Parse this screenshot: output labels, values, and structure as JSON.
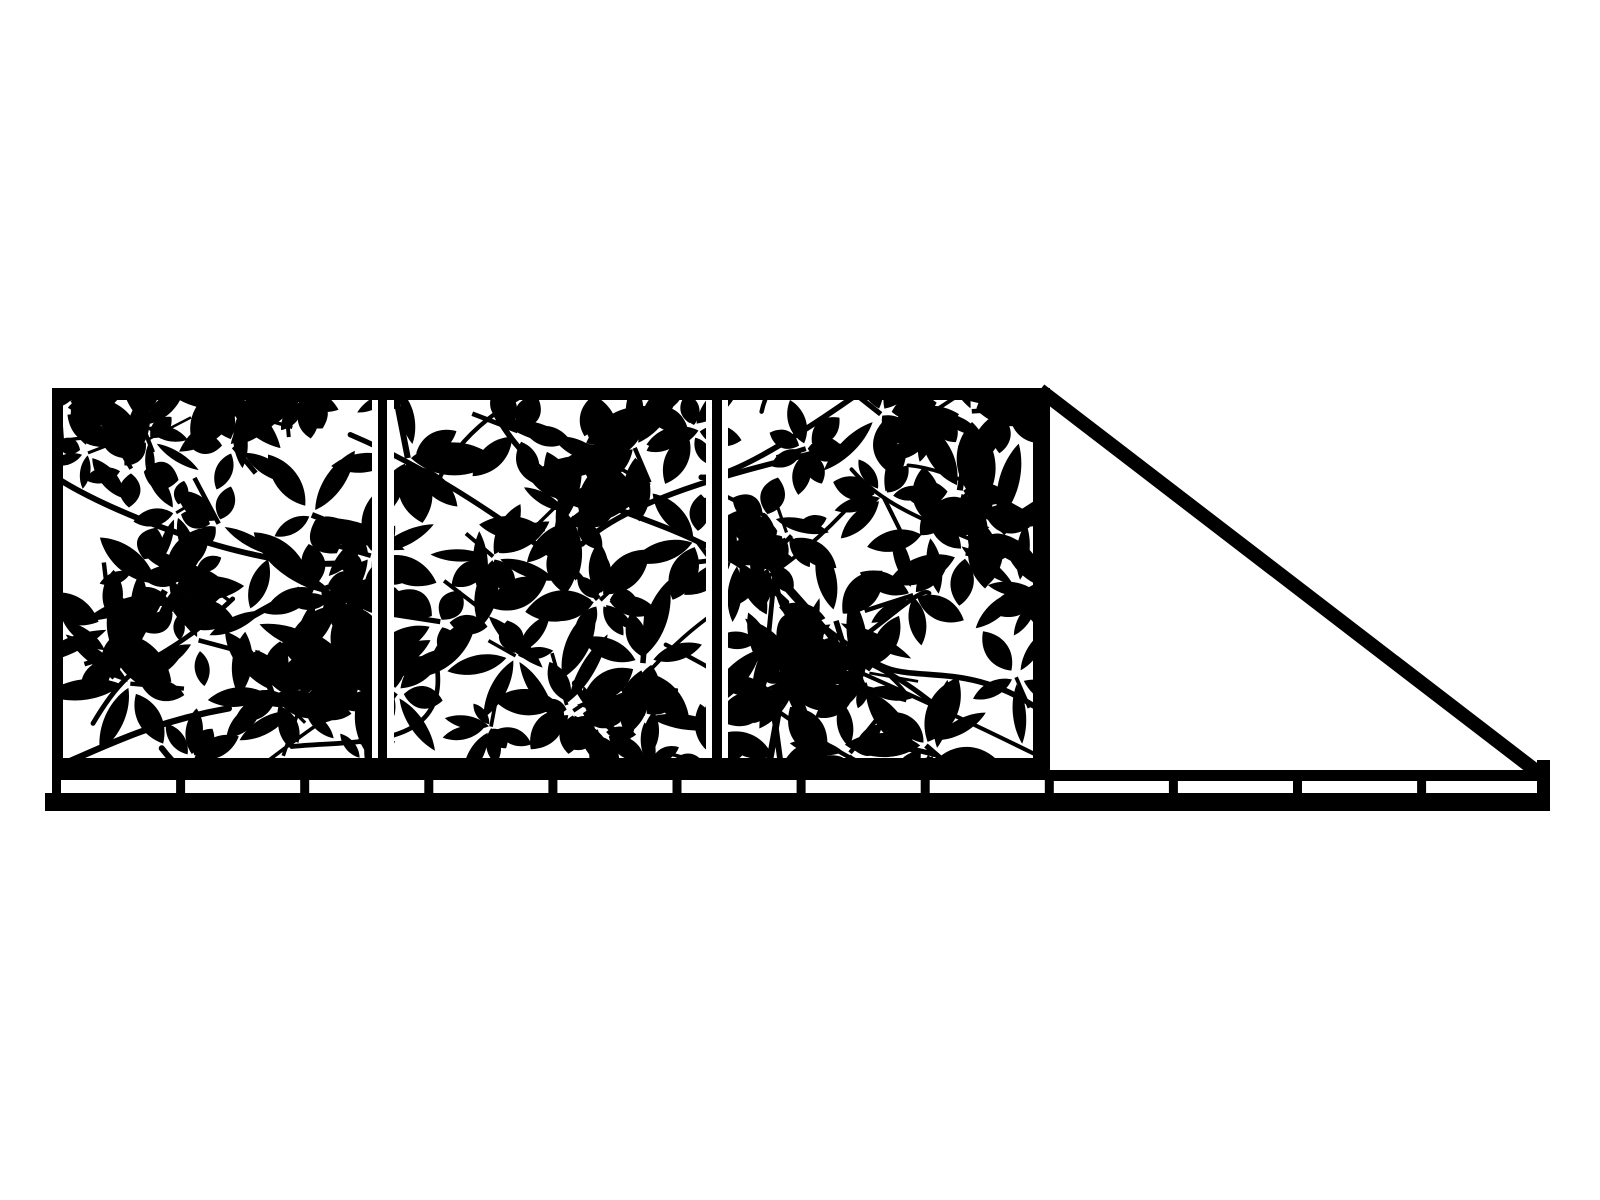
{
  "illustration": {
    "label": "Black and white silhouette of a cantilever sliding gate with decorative leaf cut-out panels, diagonal brace and bottom track",
    "type": "vector-silhouette"
  },
  "colors": {
    "ink": "#000000",
    "background": "#ffffff"
  },
  "gate": {
    "panel_count": 3,
    "divider_count": 2
  },
  "rail": {
    "tick_count": 12,
    "has_end_post": true
  },
  "pattern": {
    "seed": 7,
    "clusters": 92,
    "leaves_per_cluster_min": 4,
    "leaves_per_cluster_max": 7,
    "vines": 26
  }
}
